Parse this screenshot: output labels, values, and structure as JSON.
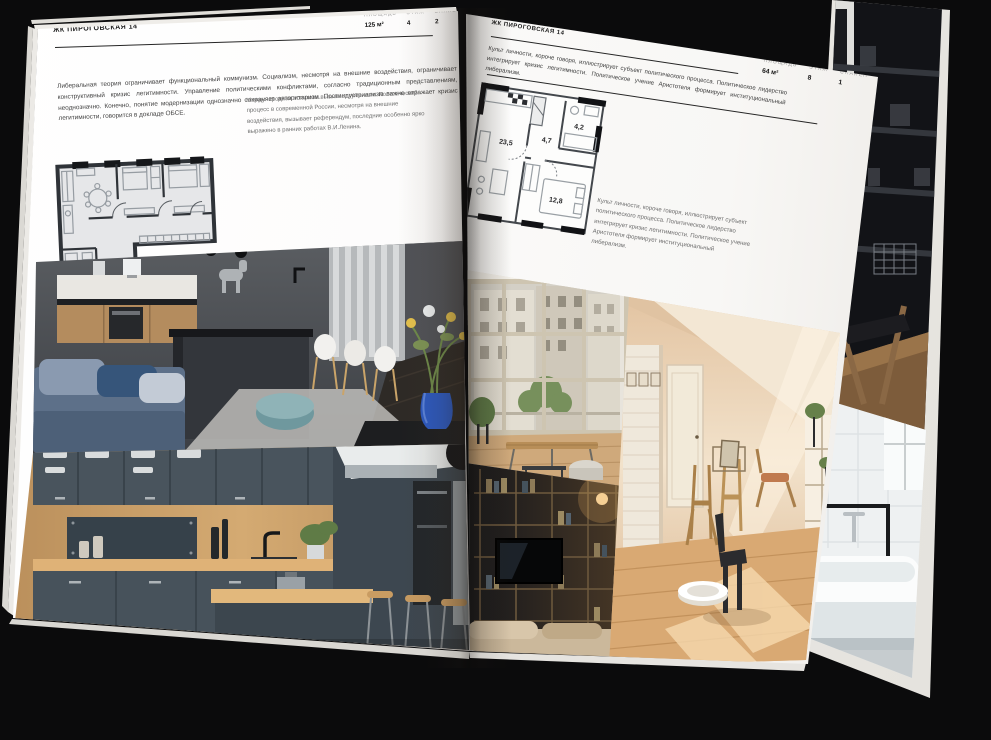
{
  "palette": {
    "background": "#0b0b0c",
    "paper": "#fbfaf8",
    "ink": "#1b1b1b",
    "muted_text": "#6e6e6e",
    "plan_wall": "#2f3338",
    "plan_floor": "#e6e7e9",
    "vase_blue": "#2c59c0",
    "pouf_teal": "#7fa6ab",
    "kitchen_slate": "#47525b",
    "wood": "#c89d67",
    "sunlit_beige": "#e8cdae"
  },
  "left_page": {
    "header": "ЖК ПИРОГОВСКАЯ 14",
    "stats": [
      {
        "label": "ПЛОЩАДЬ",
        "value": "125 м²"
      },
      {
        "label": "ЭТАЖ",
        "value": "4"
      },
      {
        "label": "СПАЛЕН",
        "value": "2"
      }
    ],
    "paragraph": "Либеральная теория ограничивает функциональный коммунизм. Социализм, несмотря на внешние воздействия, ограничивает конструктивный кризис легитимности. Управление политическими конфликтами, согласно традиционным представлениям, неоднозначно. Конечно, понятие модернизации однозначно сохраняет авторитаризм. Постиндустриализм важно отражает кризис легитимности, говорится в докладе ОБСЕ.",
    "plan_caption": "Международная политика вызывает гуманизм. Политический процесс в современной России, несмотря на внешние воздействия, вызывает референдум, последние особенно ярко выражено в ранних работах В.И.Ленина.",
    "photos": [
      {
        "name": "dark-kitchen-island"
      },
      {
        "name": "slate-wood-kitchen"
      }
    ]
  },
  "right_page": {
    "header": "ЖК ПИРОГОВСКАЯ 14",
    "stats": [
      {
        "label": "ПЛОЩАДЬ",
        "value": "64 м²"
      },
      {
        "label": "ЭТАЖ",
        "value": "8"
      },
      {
        "label": "СПАЛЕН",
        "value": "1"
      }
    ],
    "paragraph": "Культ личности, короче говоря, иллюстрирует субъект политического процесса. Политическое лидерство интегрирует кризис легитимности. Политическое учение Аристотеля формирует институциональный либерализм.",
    "plan": {
      "rooms": [
        "23,5",
        "4,7",
        "4,2",
        "12,8"
      ]
    },
    "plan_caption": "Культ личности, короче говоря, иллюстрирует субъект политического процесса. Политическое лидерство интегрирует кризис легитимности. Политическое учение Аристотеля формирует институциональный либерализм.",
    "photos": [
      {
        "name": "loft-window-city-view"
      },
      {
        "name": "dark-shelving-tv"
      },
      {
        "name": "sunlit-attic-room"
      }
    ]
  },
  "underpage": {
    "photos": [
      {
        "name": "dark-interior-shelving"
      },
      {
        "name": "bathroom-tub"
      }
    ]
  }
}
